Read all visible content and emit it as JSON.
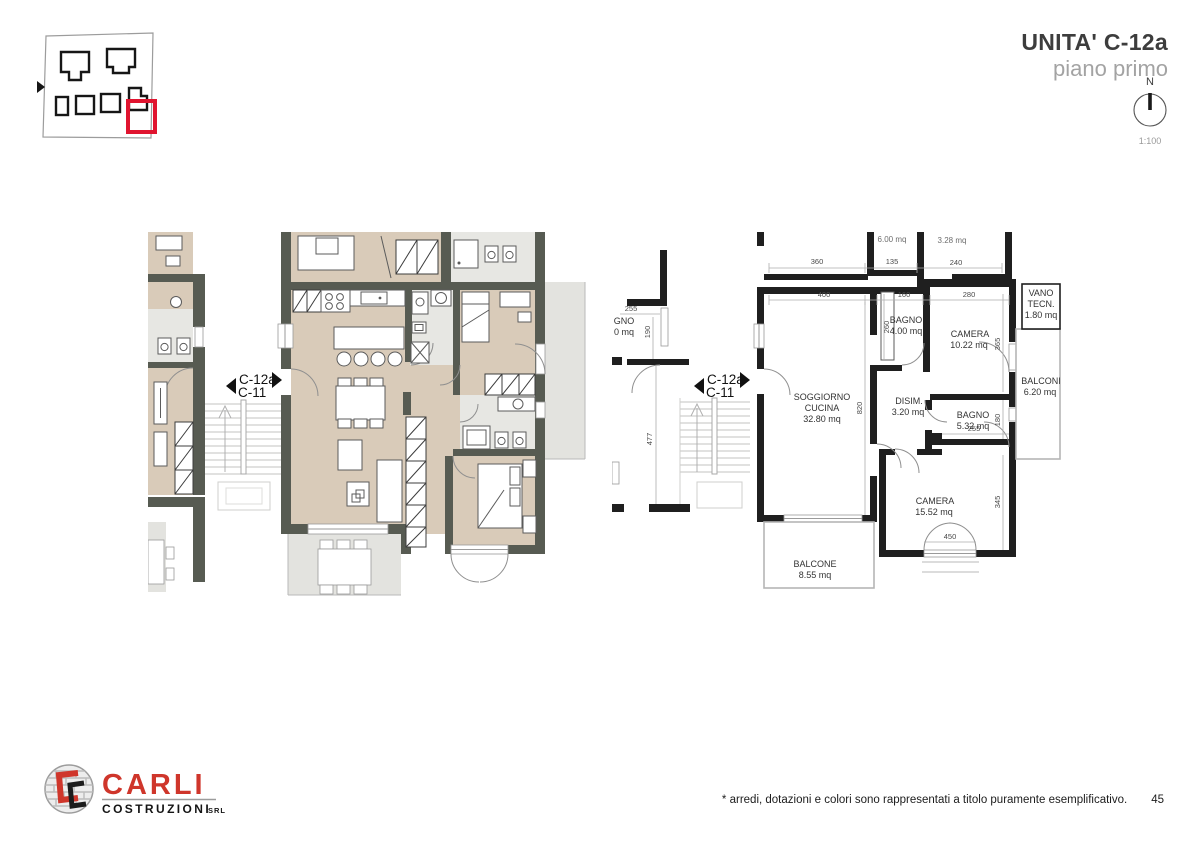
{
  "header": {
    "title": "UNITA' C-12a",
    "subtitle": "piano primo",
    "north_label": "N",
    "scale_label": "1:100"
  },
  "key_plan": {
    "highlight_color": "#e0142f"
  },
  "plans": {
    "left": {
      "unit": "C-12a",
      "neighbor": "C-11"
    },
    "right": {
      "unit": "C-12a",
      "neighbor": "C-11",
      "rooms": {
        "soggiorno": [
          "SOGGIORNO",
          "CUCINA",
          "32.80 mq"
        ],
        "bagno1": [
          "BAGNO",
          "4.00 mq"
        ],
        "camera1": [
          "CAMERA",
          "10.22 mq"
        ],
        "vano_tecn": [
          "VANO",
          "TECN.",
          "1.80 mq"
        ],
        "balconi": [
          "BALCONI",
          "6.20 mq"
        ],
        "disim": [
          "DISIM.",
          "3.20 mq"
        ],
        "bagno2": [
          "BAGNO",
          "5.32 mq"
        ],
        "camera2": [
          "CAMERA",
          "15.52 mq"
        ],
        "balcone": [
          "BALCONE",
          "8.55 mq"
        ]
      },
      "dims": {
        "d360": "360",
        "d135": "135",
        "d240": "240",
        "d400": "400",
        "d160": "160",
        "d280": "280",
        "d820": "820",
        "d260": "260",
        "d365": "365",
        "d180": "180",
        "d345": "345",
        "d450": "450",
        "d255a": "255",
        "d255b": "255",
        "d190": "190",
        "d477": "477"
      },
      "clipped": {
        "top1": "6.00 mq",
        "top2": "3.28 mq",
        "left1": "GNO",
        "left2": "0 mq"
      }
    }
  },
  "logo": {
    "name": "CARLI",
    "sub": "COSTRUZIONI",
    "srl": "SRL"
  },
  "footer": {
    "disclaimer": "* arredi, dotazioni e colori sono rappresentati a titolo puramente esemplificativo.",
    "page": "45"
  }
}
